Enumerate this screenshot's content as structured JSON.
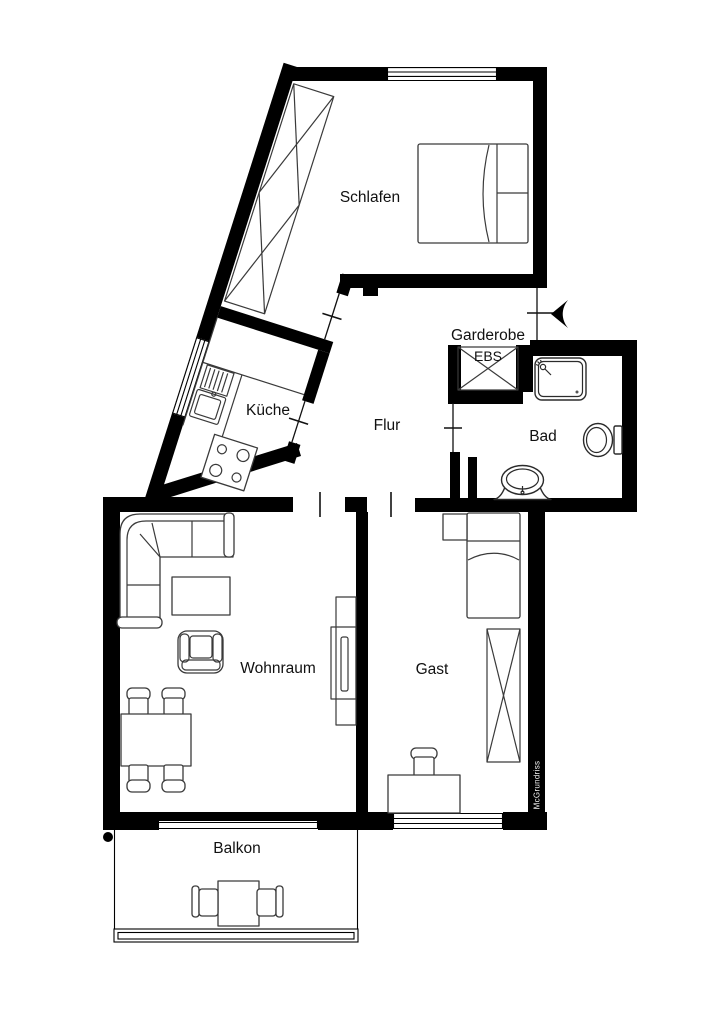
{
  "page": {
    "background": "#ffffff",
    "wall_color": "#000000",
    "furniture_line_color": "#3a3a3a",
    "text_color": "#111111"
  },
  "rooms": {
    "schlafen": {
      "label": "Schlafen"
    },
    "kueche": {
      "label": "Küche"
    },
    "flur": {
      "label": "Flur"
    },
    "garderobe": {
      "label": "Garderobe"
    },
    "ebs": {
      "label": "EBS"
    },
    "bad": {
      "label": "Bad"
    },
    "wohnraum": {
      "label": "Wohnraum"
    },
    "gast": {
      "label": "Gast"
    },
    "balkon": {
      "label": "Balkon"
    }
  },
  "watermark": {
    "label": "McGrundriss"
  },
  "icons": {
    "entrance_arrow": "filled-left-arrow",
    "shower_head": "shower-spray-glyph",
    "stove": "four-burner-cooktop",
    "corner_dot": "filled-circle"
  }
}
